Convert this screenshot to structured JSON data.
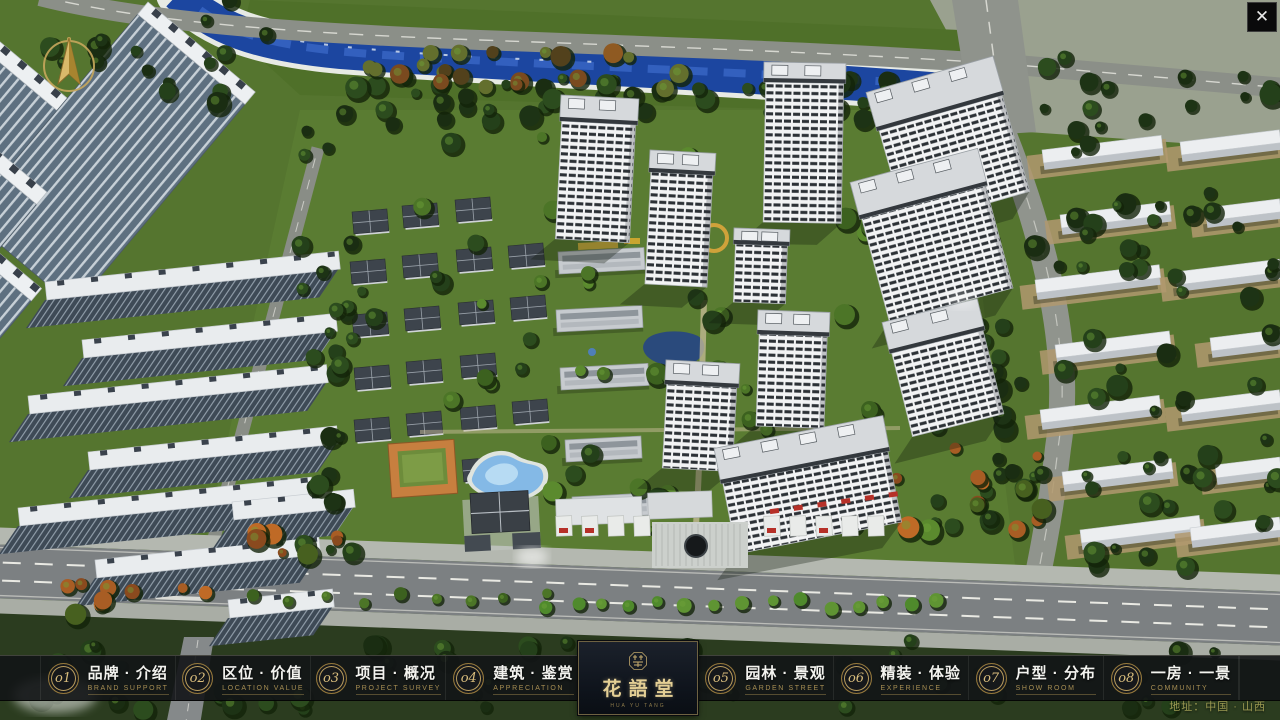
{
  "brand": {
    "title": "花語堂",
    "subtitle": "HUA YU TANG",
    "seal_label": "brand-seal"
  },
  "menu": {
    "items": [
      {
        "num": "o1",
        "label": "品牌 · 介绍",
        "sub": "BRAND SUPPORT"
      },
      {
        "num": "o2",
        "label": "区位 · 价值",
        "sub": "LOCATION VALUE"
      },
      {
        "num": "o3",
        "label": "项目 · 概况",
        "sub": "PROJECT SURVEY"
      },
      {
        "num": "o4",
        "label": "建筑 · 鉴赏",
        "sub": "APPRECIATION"
      },
      {
        "num": "o5",
        "label": "园林 · 景观",
        "sub": "GARDEN STREET"
      },
      {
        "num": "o6",
        "label": "精装 · 体验",
        "sub": "EXPERIENCE"
      },
      {
        "num": "o7",
        "label": "户型 · 分布",
        "sub": "SHOW ROOM"
      },
      {
        "num": "o8",
        "label": "一房 · 一景",
        "sub": "COMMUNITY"
      }
    ]
  },
  "footer": {
    "address": "地址：中国 · 山西"
  },
  "icons": {
    "close_glyph": "✕",
    "compass": "gold-north-arrow"
  },
  "colors": {
    "gold_accent": "#b99d5e",
    "logo_text": "#e4cf95",
    "bar_background": "#121416",
    "river_blue": "#1c46a0",
    "address_text": "#9c9a52"
  }
}
